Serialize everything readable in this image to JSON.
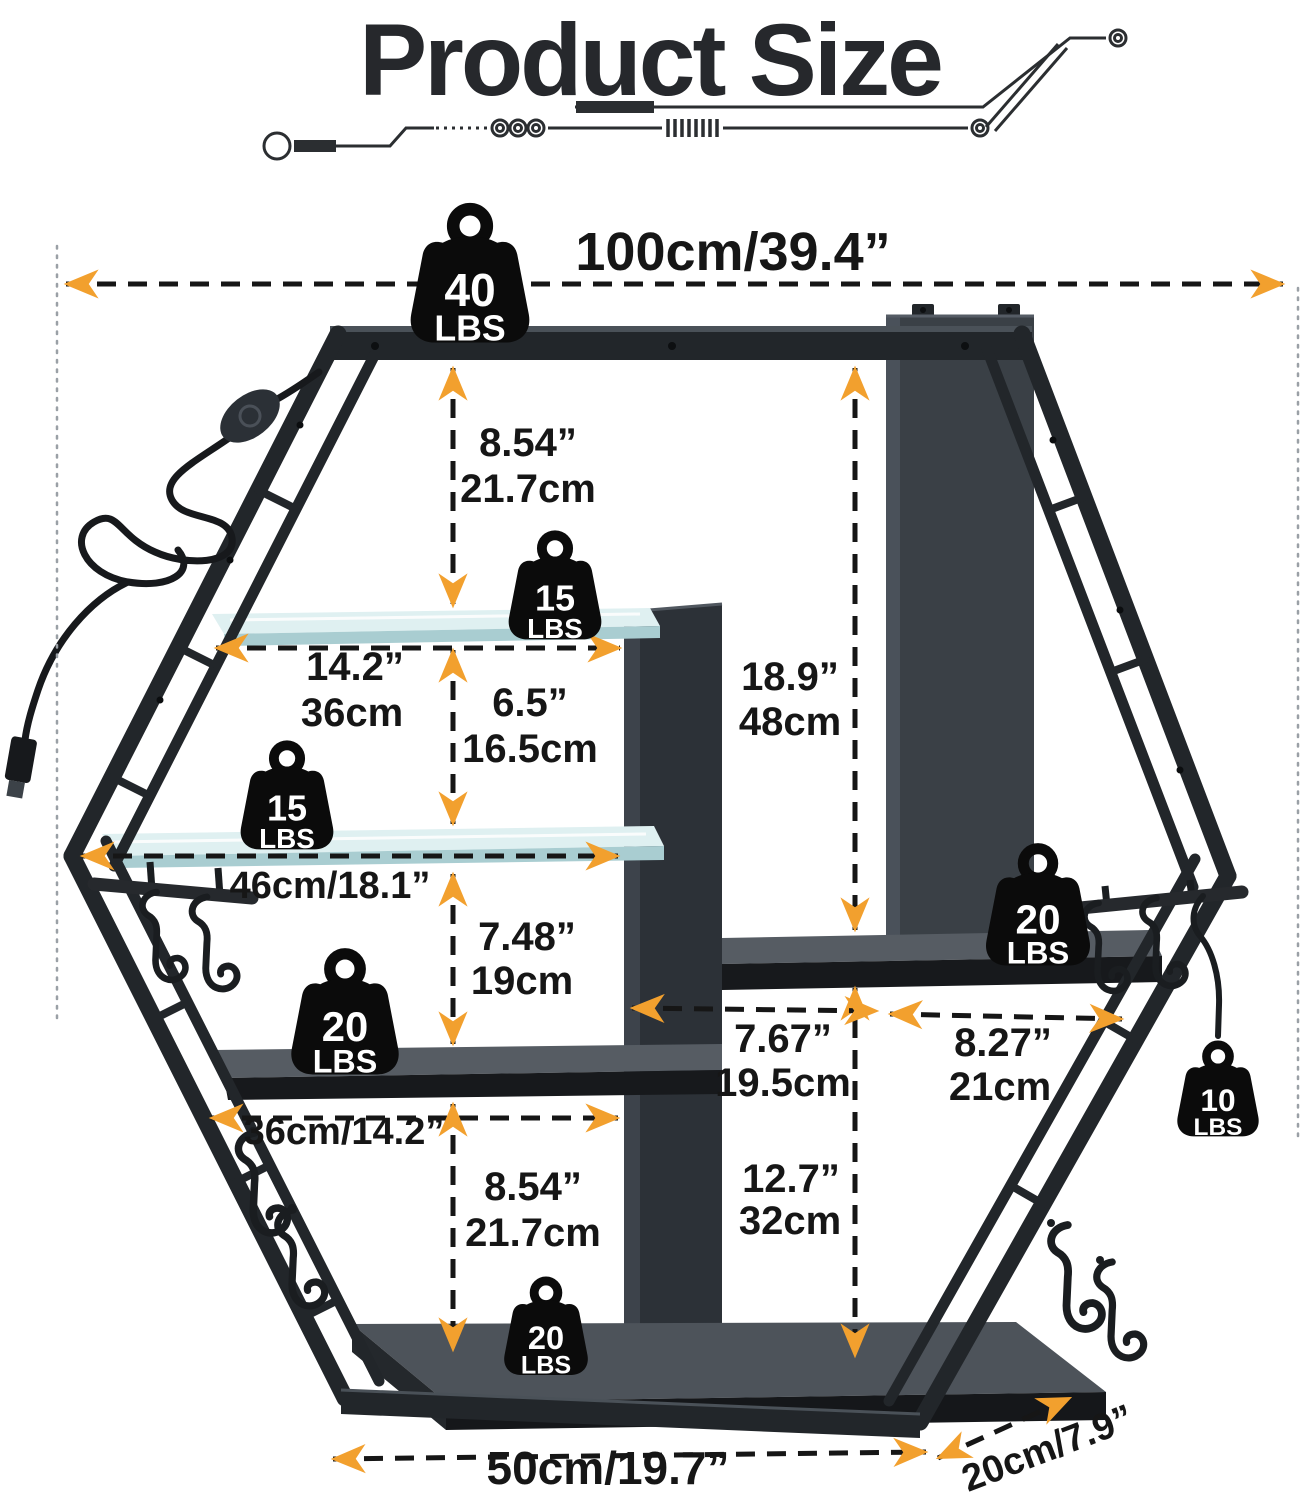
{
  "title": "Product Size",
  "colors": {
    "accent_orange": "#F2A02E",
    "frame_black": "#22262A",
    "panel_gray": "#3A4046",
    "glass": "#DFF0F1",
    "dimension_text": "#161616"
  },
  "weights": {
    "top": {
      "value": "40",
      "unit": "LBS"
    },
    "glass_upper": {
      "value": "15",
      "unit": "LBS"
    },
    "glass_lower": {
      "value": "15",
      "unit": "LBS"
    },
    "mid_left": {
      "value": "20",
      "unit": "LBS"
    },
    "right": {
      "value": "20",
      "unit": "LBS"
    },
    "hook_right": {
      "value": "10",
      "unit": "LBS"
    },
    "bottom": {
      "value": "20",
      "unit": "LBS"
    }
  },
  "dimensions": {
    "overall_width": "100cm/39.4”",
    "top_to_glass1": {
      "inch": "8.54”",
      "metric": "21.7cm"
    },
    "glass1_width": {
      "inch": "14.2”",
      "metric": "36cm"
    },
    "glass_gap": {
      "inch": "6.5”",
      "metric": "16.5cm"
    },
    "back_column_height": {
      "inch": "18.9”",
      "metric": "48cm"
    },
    "glass2_width": "46cm/18.1”",
    "glass2_to_shelf": {
      "inch": "7.48”",
      "metric": "19cm"
    },
    "mid_shelf_width": "36cm/14.2”",
    "shelf_to_bottom": {
      "inch": "8.54”",
      "metric": "21.7cm"
    },
    "center_slot_width": {
      "inch": "7.67”",
      "metric": "19.5cm"
    },
    "right_slot_width": {
      "inch": "8.27”",
      "metric": "21cm"
    },
    "bottom_column_height": {
      "inch": "12.7”",
      "metric": "32cm"
    },
    "bottom_width": "50cm/19.7”",
    "depth": "20cm/7.9”"
  }
}
